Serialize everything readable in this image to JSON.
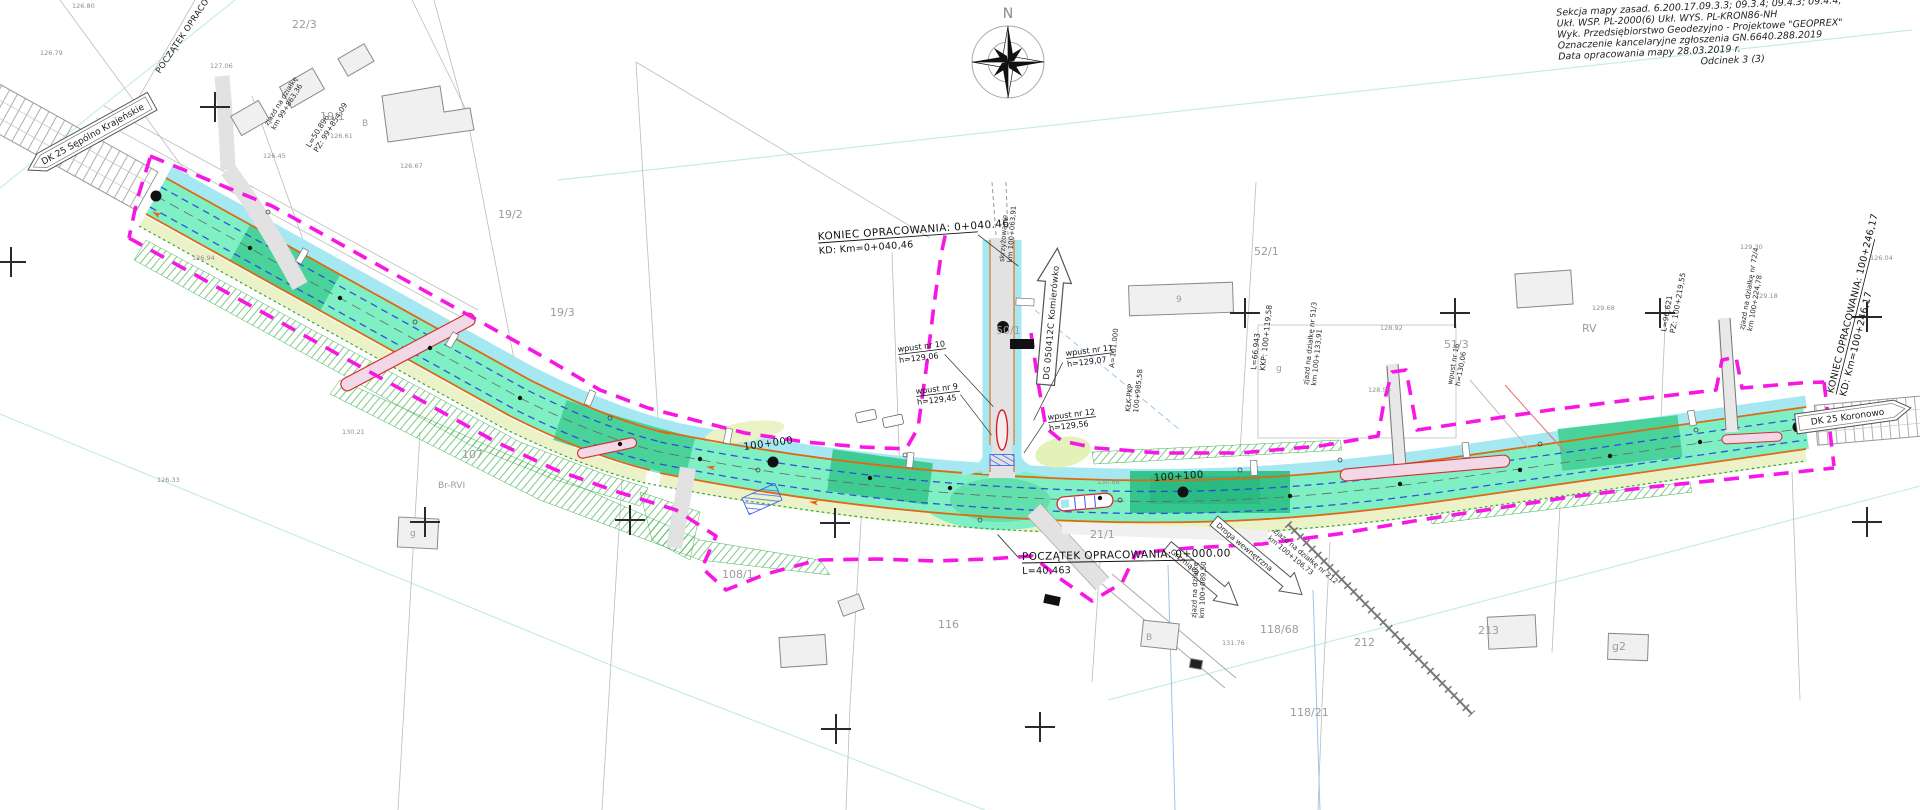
{
  "info_block": {
    "lines": [
      "Sekcja mapy zasad. 6.200.17.09.3.3;  09.3.4;  09.4.3;  09.4.4;",
      "Ukł. WSP. PL-2000(6)        Ukł. WYS. PL-KRON86-NH",
      "Wyk. Przedsiębiorstwo Geodezyjno - Projektowe \"GEOPREX\"",
      "Oznaczenie kancelaryjne zgłoszenia GN.6640.288.2019",
      "Data opracowania mapy 28.03.2019 r.",
      "Odcinek 3 (3)"
    ]
  },
  "compass": {
    "label": "N"
  },
  "roads": {
    "left": "DK 25 Sępólno Krajeńskie",
    "right": "DK 25 Koronowo",
    "side": "DG 050412C Komierówko",
    "arrow_inner": "Droga wewnętrzna",
    "arrow_grzmiaca": "Grzmiąca"
  },
  "milestones": {
    "koniec_side_1": "KONIEC OPRACOWANIA: 0+040.46",
    "koniec_side_2": "KD: Km=0+040,46",
    "poczatek_1": "POCZĄTEK OPRACOWANIA: 0+000.00",
    "poczatek_2": "L=40,463",
    "koniec_right_1": "KONIEC OPRACOWANIA: 100+246,17",
    "koniec_right_2": "KD: Km=100+246,17",
    "poczatek_left": "POCZĄTEK OPRACOWANIA",
    "km_100000": "100+000",
    "km_100100": "100+100"
  },
  "inlets": [
    {
      "name": "wpust nr 10",
      "h": "h=129,06"
    },
    {
      "name": "wpust nr 9",
      "h": "h=129,45"
    },
    {
      "name": "wpust nr 11",
      "h": "h=129,07"
    },
    {
      "name": "wpust nr 12",
      "h": "h=129,56"
    },
    {
      "name": "wpust nr 16",
      "h": "h=130,06"
    }
  ],
  "notes": [
    {
      "l1": "zjazd na działkę",
      "l2": "km 99+863,36"
    },
    {
      "l1": "L=50,896",
      "l2": "PZ: 99+854,09"
    },
    {
      "l1": "skrzyżowanie",
      "l2": "km 100+063,91"
    },
    {
      "l1": "A=101.000",
      "l2": ""
    },
    {
      "l1": "KŁK-PKP",
      "l2": "100+985,58"
    },
    {
      "l1": "L=66,943",
      "l2": "KKP: 100+119,58"
    },
    {
      "l1": "zjazd na działkę nr 51/3",
      "l2": "km 100+133,91"
    },
    {
      "l1": "zjazd na działkę nr 212",
      "l2": "km 100+106,73"
    },
    {
      "l1": "zjazd na działkę",
      "l2": "km 100+089,50"
    },
    {
      "l1": "L=96,621",
      "l2": "PZ: 100+219,55"
    },
    {
      "l1": "zjazd na działkę nr 72/4",
      "l2": "km 100+224,78"
    }
  ],
  "parcels": [
    "22/3",
    "19/1",
    "B",
    "19/2",
    "19/3",
    "107",
    "Br-RVI",
    "108/1",
    "116",
    "50/1",
    "52/1",
    "51/3",
    "21/1",
    "118/68",
    "118/21",
    "212",
    "213",
    "g2",
    "g",
    "g",
    "9",
    "B",
    "RV"
  ],
  "elevations": [
    "126.80",
    "126.79",
    "127.06",
    "126.61",
    "126.67",
    "126.45",
    "126.94",
    "126.33",
    "130.21",
    "130.68",
    "128.92",
    "128.50",
    "129.30",
    "129.18",
    "129.68",
    "126.04",
    "131.76"
  ]
}
